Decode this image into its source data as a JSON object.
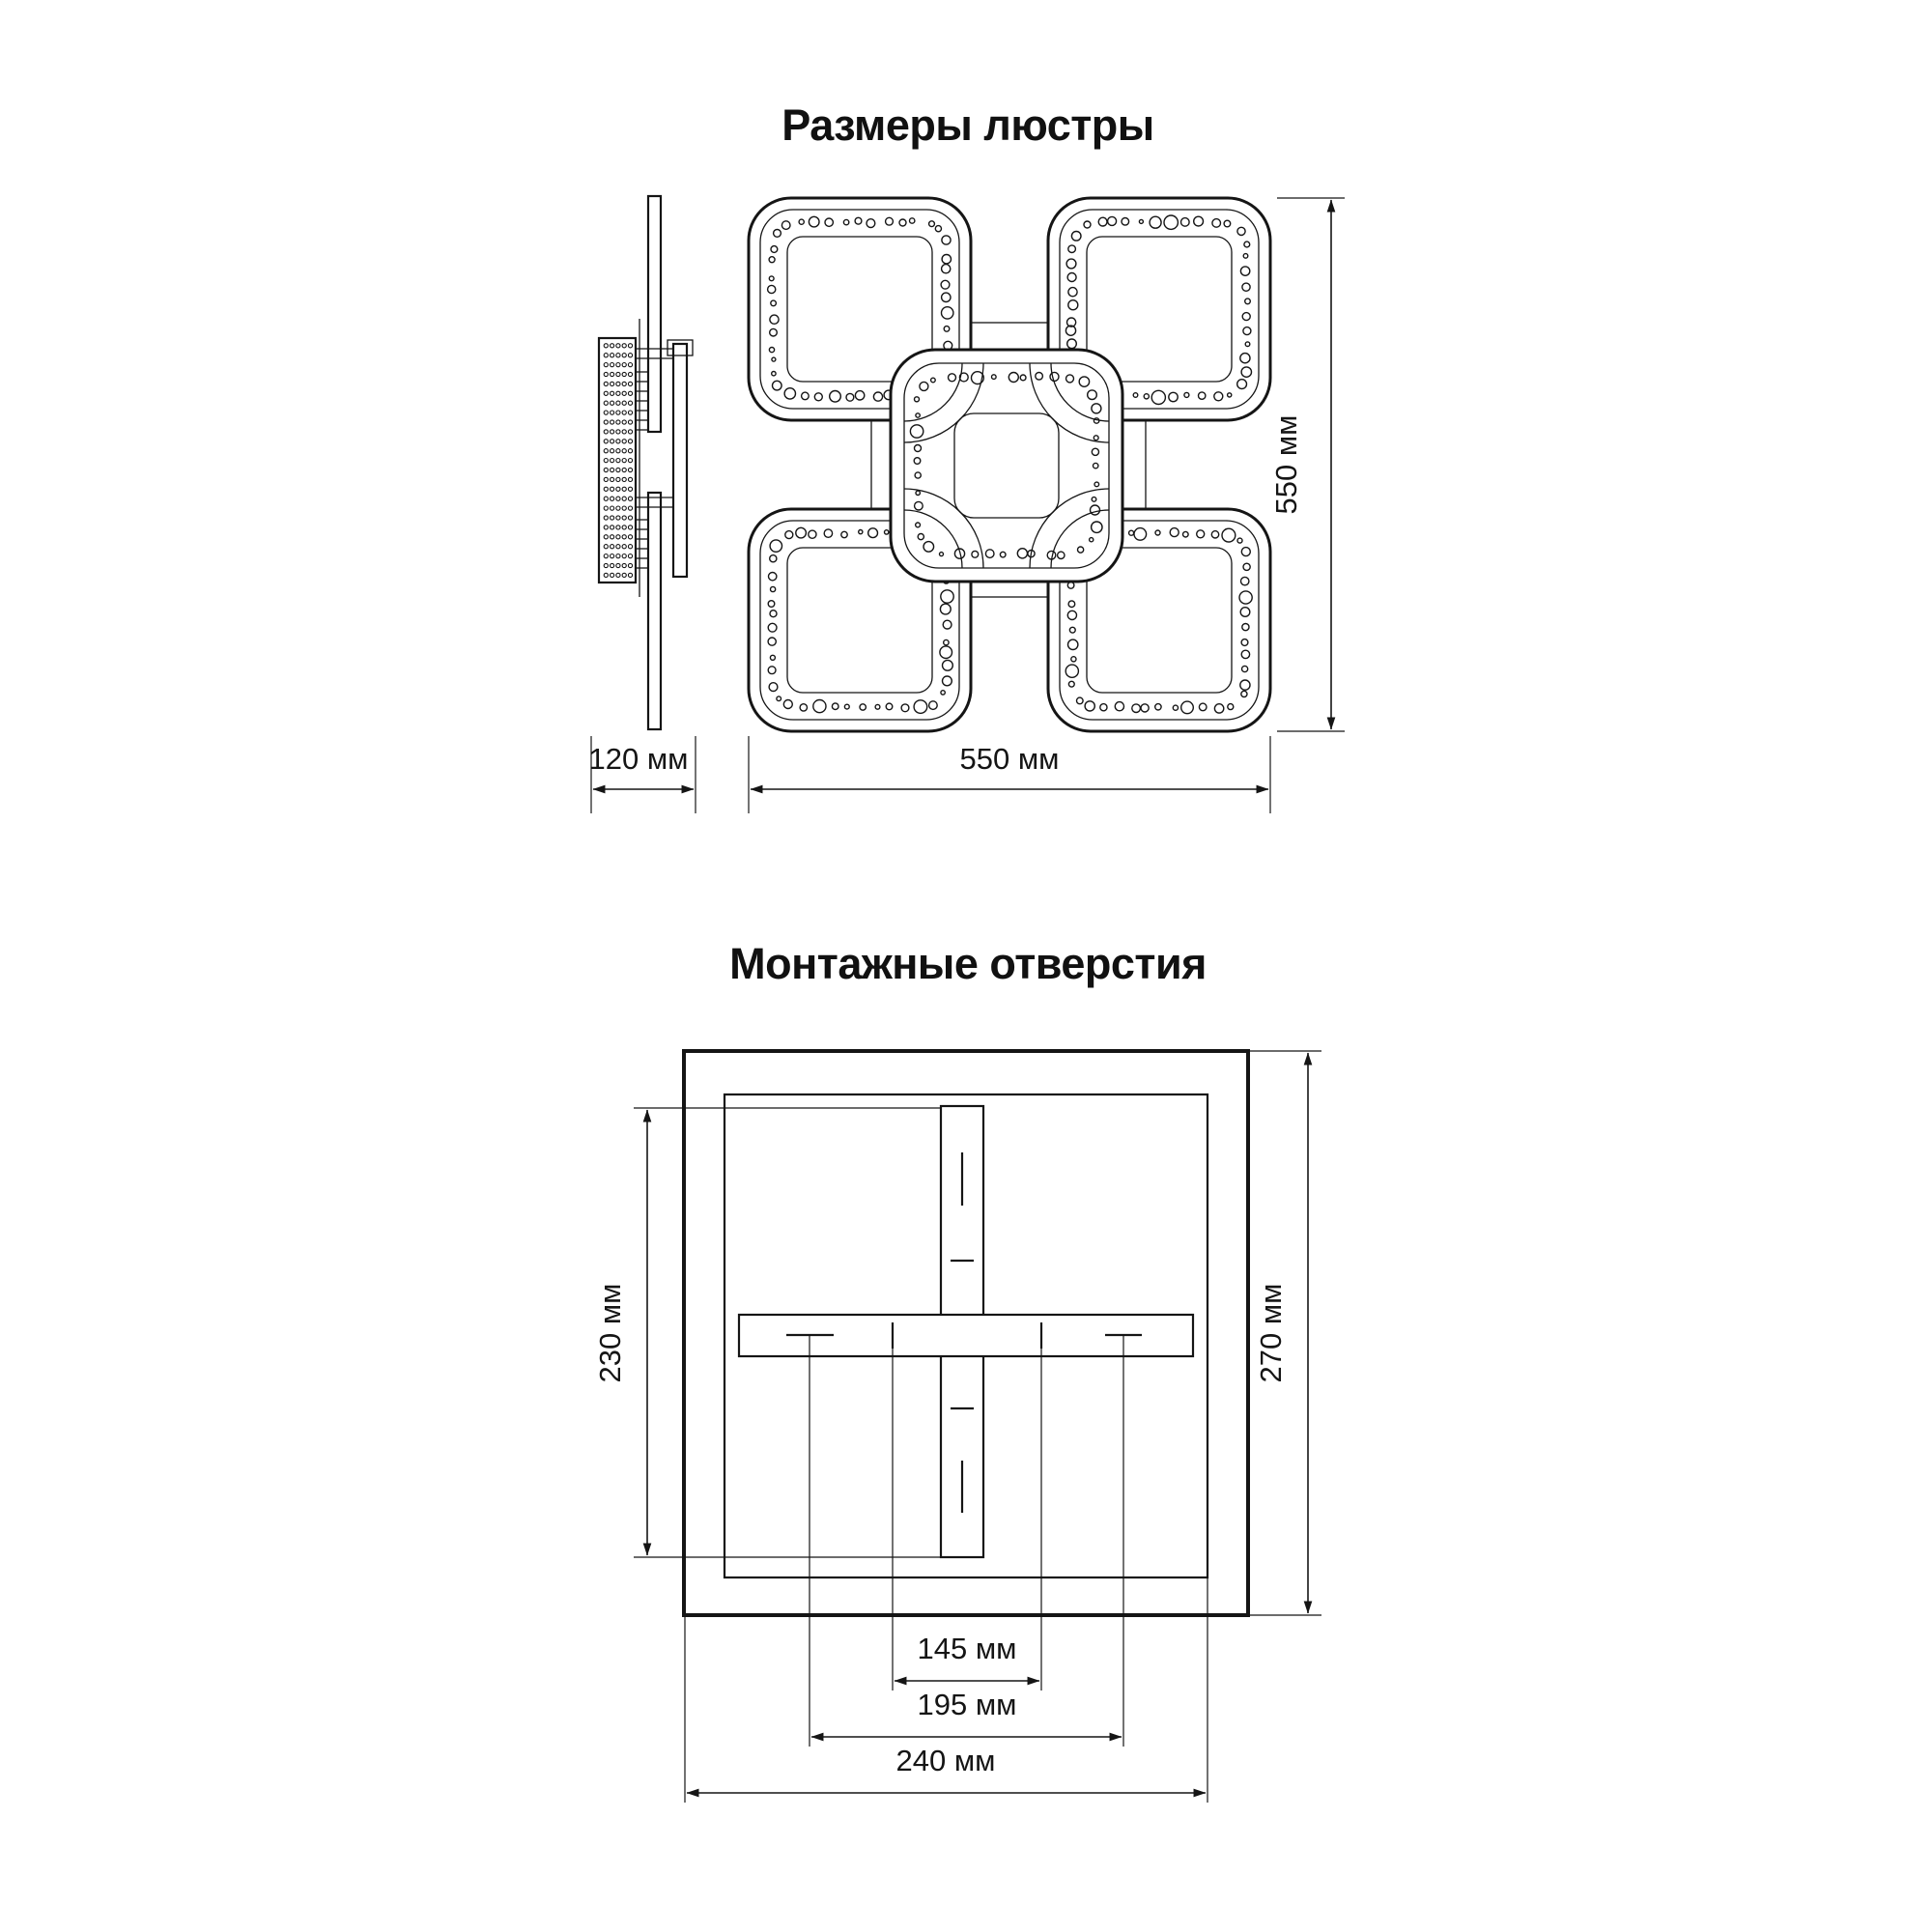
{
  "page": {
    "background_color": "#ffffff",
    "ink_color": "#151515"
  },
  "chandelier_drawing": {
    "title": "Размеры люстры",
    "depth_label": "120 мм",
    "width_label": "550 мм",
    "height_label": "550 мм"
  },
  "mounting_drawing": {
    "title": "Монтажные отверстия",
    "bracket_length_label": "230 мм",
    "plate_size_label": "270 мм",
    "hole_spacing_labels": [
      "145 мм",
      "195 мм",
      "240 мм"
    ]
  }
}
